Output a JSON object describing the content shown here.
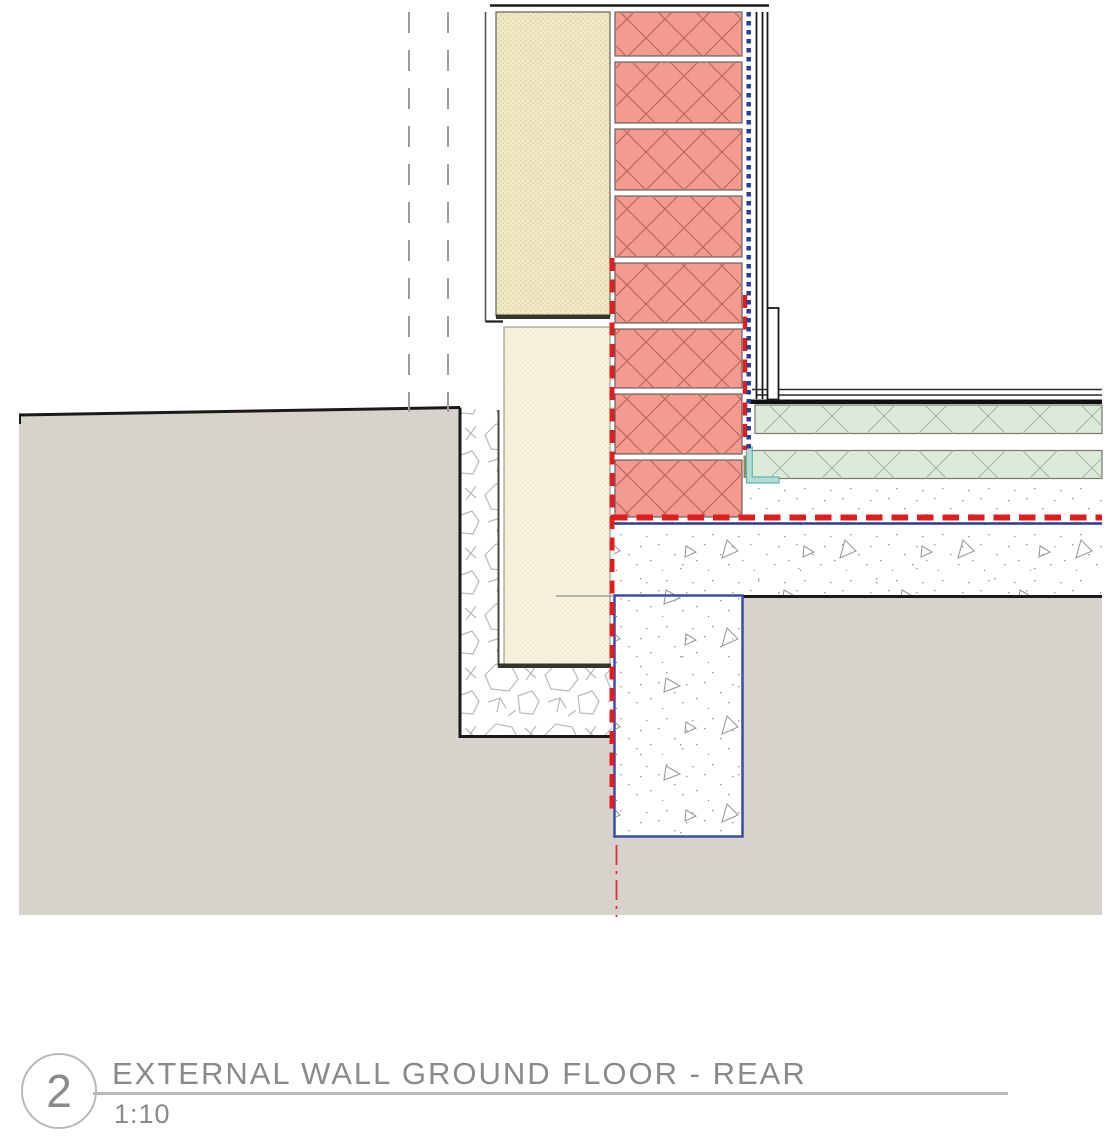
{
  "drawing": {
    "number": "2",
    "title": "EXTERNAL WALL GROUND FLOOR - REAR",
    "scale": "1:10"
  },
  "colors": {
    "brick": "#f49a8e",
    "brick-hatch": "#c06a5e",
    "insul-outer": "#efe9c3",
    "insul-outer-dot": "#d8cf9e",
    "insul-lower": "#f6f2dd",
    "insul-lower-dot": "#e9e3c6",
    "screed-green": "#dcead9",
    "green-hatch": "#a9b4a9",
    "earth": "#d7d2cc",
    "stone": "#b9b9b9",
    "speckle": "#9a9a9a",
    "membrane-red": "#df1f1f",
    "dpc-blue": "#2b3f96",
    "foundation-blue": "#3c4da3",
    "slab-line-blue": "#2c3b92",
    "teal": "#b3dcd7",
    "teal-edge": "#5fb7ae",
    "olive": "#97855c",
    "line-dark": "#1a1a1a",
    "title-grey": "#8a8a8a",
    "rule-grey": "#b9b9b9",
    "dash-grey": "#9c9c9c"
  }
}
